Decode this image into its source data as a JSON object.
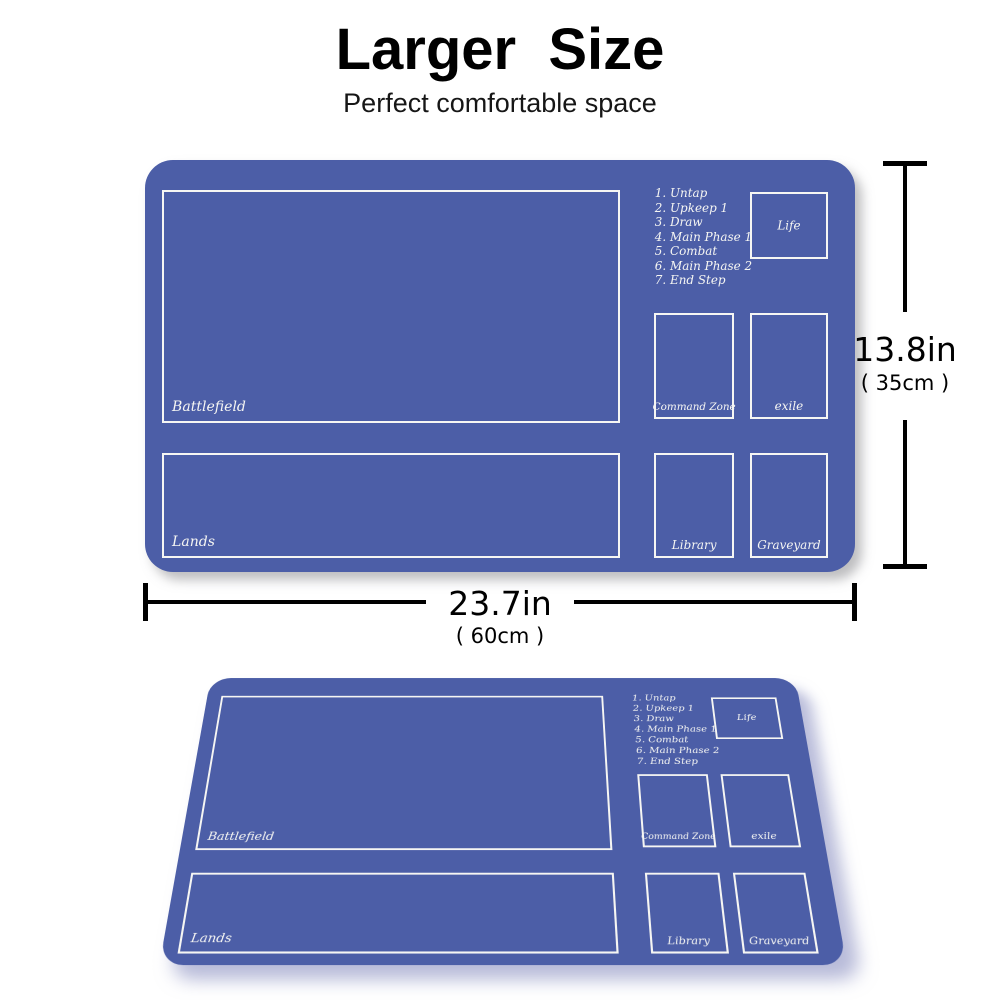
{
  "header": {
    "title": "Larger  Size",
    "subtitle": "Perfect comfortable space"
  },
  "playmat": {
    "color": "#4c5ea7",
    "border_color": "#f6f6f3",
    "zones": {
      "battlefield": "Battlefield",
      "lands": "Lands",
      "life": "Life",
      "command_zone": "Command Zone",
      "exile": "exile",
      "library": "Library",
      "graveyard": "Graveyard"
    },
    "phases": [
      "1. Untap",
      "2. Upkeep 1",
      "3. Draw",
      "4. Main Phase 1",
      "5. Combat",
      "6. Main Phase 2",
      "7. End Step"
    ]
  },
  "dimensions": {
    "height": {
      "inches": "13.8in",
      "metric": "( 35cm )"
    },
    "width": {
      "inches": "23.7in",
      "metric": "( 60cm )"
    }
  }
}
